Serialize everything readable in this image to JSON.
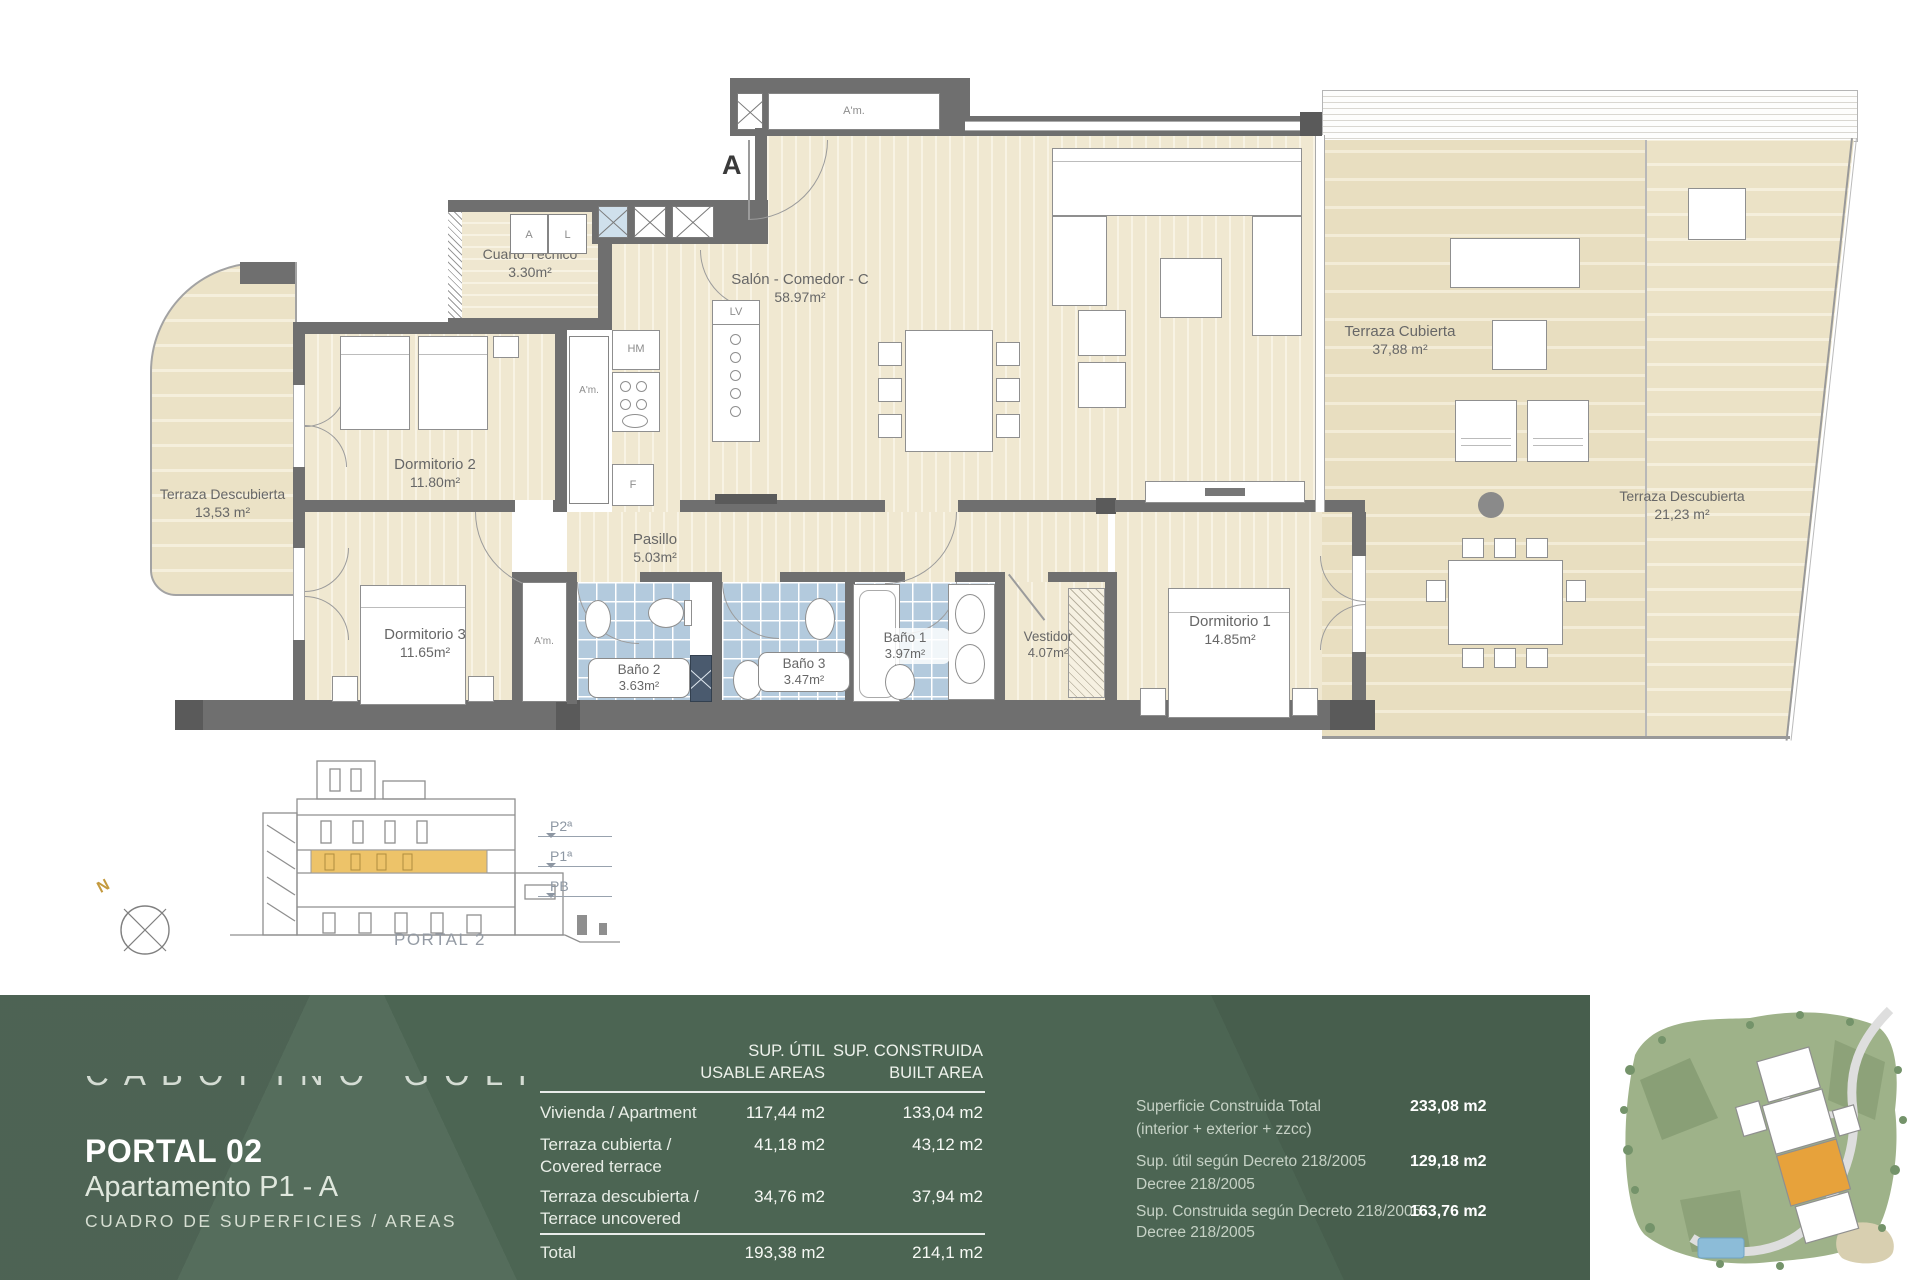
{
  "plan": {
    "entrance_label": "A",
    "rooms": {
      "salon": {
        "name": "Salón - Comedor - C",
        "area": "58.97m²"
      },
      "cuarto_tecnico": {
        "name": "Cuarto Técnico",
        "area": "3.30m²"
      },
      "terraza_izquierda": {
        "name": "Terraza Descubierta",
        "area": "13,53 m²"
      },
      "dormitorio2": {
        "name": "Dormitorio 2",
        "area": "11.80m²"
      },
      "dormitorio3": {
        "name": "Dormitorio 3",
        "area": "11.65m²"
      },
      "pasillo": {
        "name": "Pasillo",
        "area": "5.03m²"
      },
      "bano2": {
        "name": "Baño 2",
        "area": "3.63m²"
      },
      "bano3": {
        "name": "Baño 3",
        "area": "3.47m²"
      },
      "bano1": {
        "name": "Baño 1",
        "area": "3.97m²"
      },
      "vestidor": {
        "name": "Vestidor",
        "area": "4.07m²"
      },
      "dormitorio1": {
        "name": "Dormitorio 1",
        "area": "14.85m²"
      },
      "terraza_cubierta": {
        "name": "Terraza Cubierta",
        "area": "37,88 m²"
      },
      "terraza_derecha": {
        "name": "Terraza Descubierta",
        "area": "21,23 m²"
      }
    },
    "fixture_labels": {
      "armario_entrada": "A'm.",
      "armario_cocina": "A'm.",
      "armario_dormitorio3": "A'm.",
      "caldera_a": "A",
      "lavadora_l": "L",
      "horno_microondas": "HM",
      "frigorifico": "F",
      "lavavajillas": "LV"
    }
  },
  "section": {
    "caption": "PORTAL 2",
    "levels": {
      "p2": "P2ª",
      "p1": "P1ª",
      "pb": "PB"
    },
    "compass_north": "N"
  },
  "footer": {
    "brand_watermark": "CABOPINO GOLF",
    "portal": "PORTAL 02",
    "apartment": "Apartamento P1 - A",
    "subtitle": "CUADRO DE SUPERFICIES / AREAS",
    "table": {
      "header_useful_line1": "SUP. ÚTIL",
      "header_useful_line2": "USABLE AREAS",
      "header_built_line1": "SUP. CONSTRUIDA",
      "header_built_line2": "BUILT AREA",
      "rows": [
        {
          "label_line1": "Vivienda / Apartment",
          "label_line2": "",
          "useful": "117,44 m2",
          "built": "133,04 m2"
        },
        {
          "label_line1": "Terraza cubierta /",
          "label_line2": "Covered terrace",
          "useful": "41,18 m2",
          "built": "43,12 m2"
        },
        {
          "label_line1": "Terraza descubierta /",
          "label_line2": "Terrace uncovered",
          "useful": "34,76 m2",
          "built": "37,94 m2"
        }
      ],
      "total_label": "Total",
      "total_useful": "193,38 m2",
      "total_built": "214,1 m2"
    },
    "summary": [
      {
        "label_line1": "Superficie Construida Total",
        "label_line2": "(interior + exterior + zzcc)",
        "value": "233,08 m2"
      },
      {
        "label_line1": "Sup. útil según Decreto 218/2005",
        "label_line2": "Decree 218/2005",
        "value": "129,18 m2"
      },
      {
        "label_line1": "Sup. Construida según Decreto 218/2005",
        "label_line2": "Decree 218/2005",
        "value": "163,76 m2"
      }
    ],
    "colors": {
      "band_green": "#4c6553",
      "highlight_orange": "#e7a23b",
      "tile_blue": "#b3cadd"
    }
  }
}
